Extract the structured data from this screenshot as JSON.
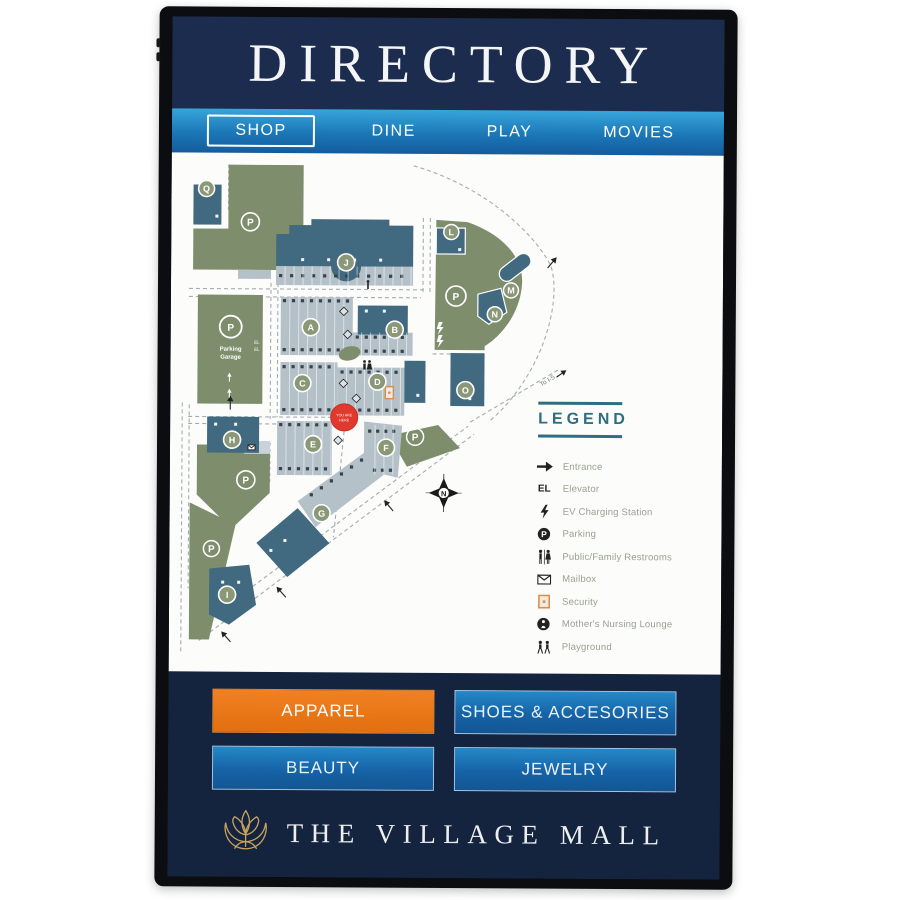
{
  "header": {
    "title": "DIRECTORY"
  },
  "tabs": [
    {
      "label": "SHOP",
      "active": true
    },
    {
      "label": "DINE",
      "active": false
    },
    {
      "label": "PLAY",
      "active": false
    },
    {
      "label": "MOVIES",
      "active": false
    }
  ],
  "map": {
    "letters": {
      "a": "A",
      "b": "B",
      "c": "C",
      "d": "D",
      "e": "E",
      "f": "F",
      "g": "G",
      "h": "H",
      "i": "I",
      "j": "J",
      "l": "L",
      "m": "M",
      "n": "N",
      "o": "O",
      "q": "Q",
      "p": "P"
    },
    "you_are_here_lines": [
      "YOU ARE",
      "HERE"
    ],
    "parking_garage_lines": [
      "Parking",
      "Garage"
    ],
    "elevator_abbr": "EL",
    "to_i5": "To I-5",
    "compass": "N"
  },
  "legend": {
    "title": "LEGEND",
    "items": [
      {
        "icon": "entrance-arrow-icon",
        "label": "Entrance"
      },
      {
        "icon": "elevator-icon",
        "label": "Elevator"
      },
      {
        "icon": "ev-charging-icon",
        "label": "EV Charging Station"
      },
      {
        "icon": "parking-icon",
        "label": "Parking"
      },
      {
        "icon": "restrooms-icon",
        "label": "Public/Family Restrooms"
      },
      {
        "icon": "mailbox-icon",
        "label": "Mailbox"
      },
      {
        "icon": "security-icon",
        "label": "Security"
      },
      {
        "icon": "nursing-lounge-icon",
        "label": "Mother's Nursing Lounge"
      },
      {
        "icon": "playground-icon",
        "label": "Playground"
      }
    ]
  },
  "categories": [
    {
      "label": "APPAREL",
      "active": true
    },
    {
      "label": "SHOES & ACCESORIES",
      "active": false
    },
    {
      "label": "BEAUTY",
      "active": false
    },
    {
      "label": "JEWELRY",
      "active": false
    }
  ],
  "footer": {
    "brand": "THE VILLAGE MALL"
  },
  "colors": {
    "screen_navy": "#16253F",
    "header_navy": "#1C2C4E",
    "tab_blue_top": "#37A5DB",
    "tab_blue_bottom": "#145C9D",
    "button_blue": "#1663A6",
    "accent_orange": "#E8791F",
    "map_green": "#7E8E6D",
    "map_teal": "#41697F",
    "map_gray": "#B5C1C8",
    "legend_teal": "#2E6E80",
    "marker_red": "#E0392E",
    "brand_gold": "#C8A35F"
  }
}
